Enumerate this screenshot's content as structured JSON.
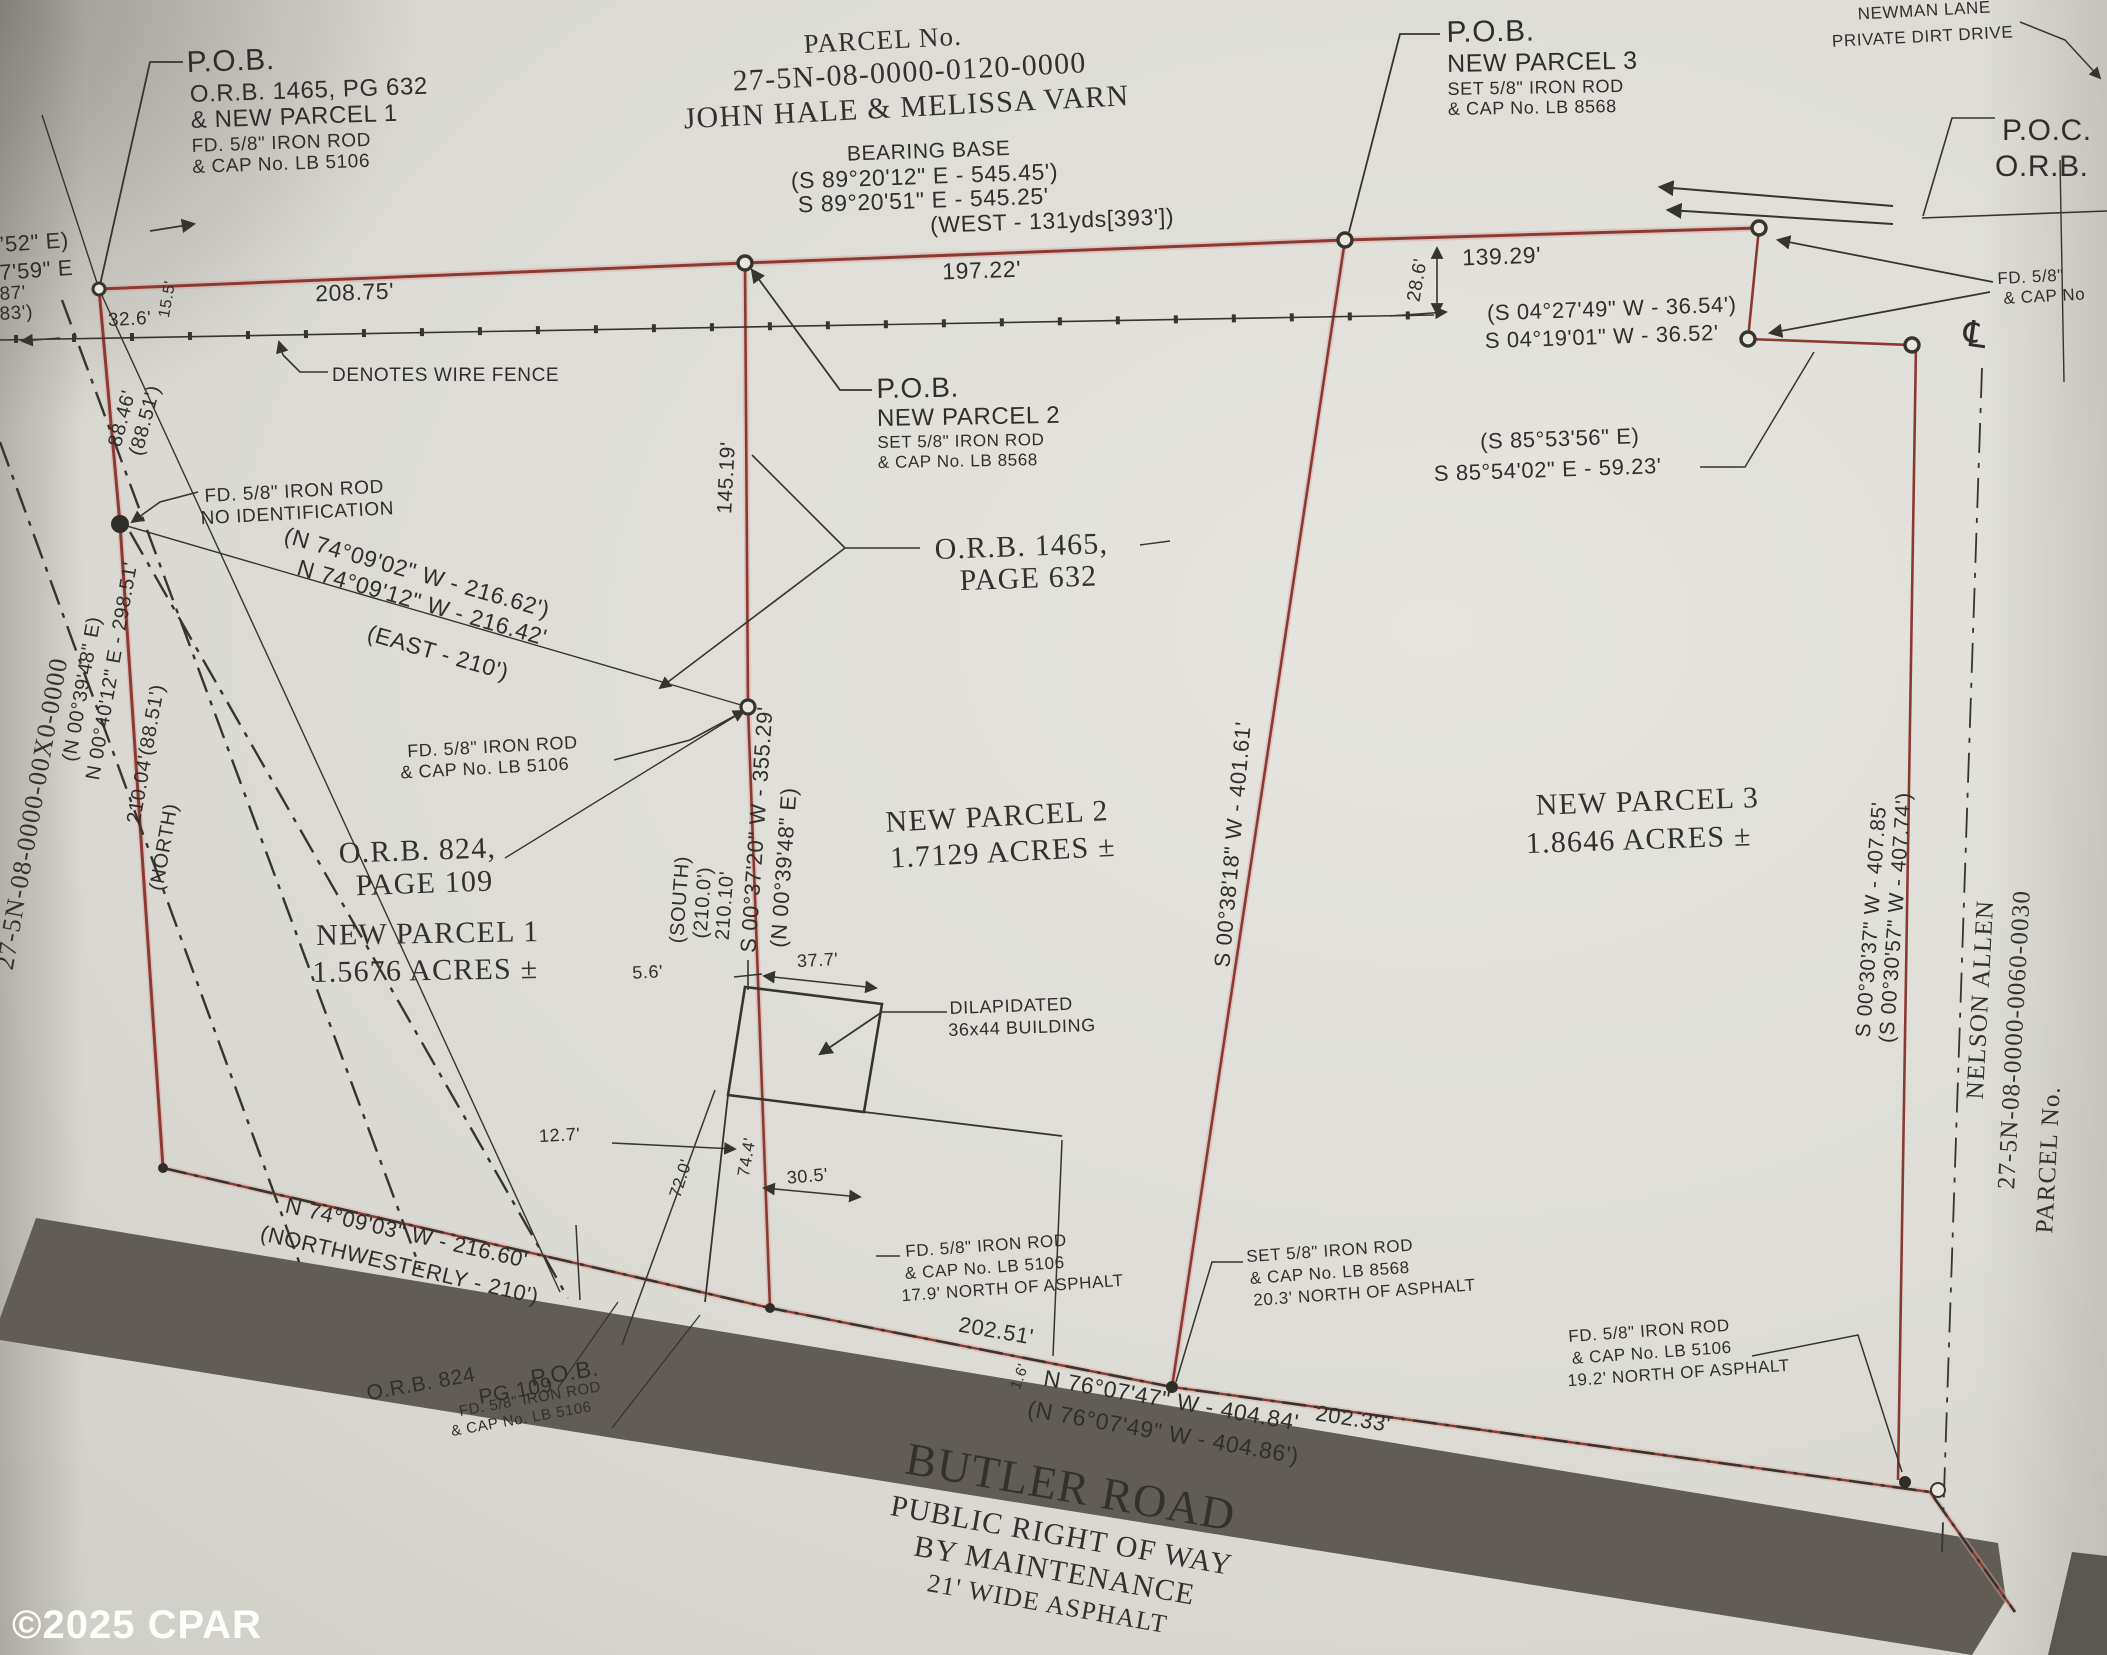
{
  "plat": {
    "watermark": "©2025 CPAR",
    "subject_parcel": {
      "label": "PARCEL No.",
      "number": "27-5N-08-0000-0120-0000",
      "owner": "JOHN HALE & MELISSA VARN"
    },
    "bearing_base": {
      "title": "BEARING BASE",
      "record": "(S 89°20'12\" E - 545.45')",
      "measured": "S 89°20'51\" E - 545.25'",
      "west_tie": "(WEST - 131yds[393'])"
    },
    "pob_parcel1": [
      "P.O.B.",
      "O.R.B. 1465, PG 632",
      "& NEW PARCEL 1",
      "FD. 5/8\" IRON ROD",
      "& CAP No. LB 5106"
    ],
    "pob_parcel2": [
      "P.O.B.",
      "NEW PARCEL 2",
      "SET 5/8\" IRON ROD",
      "& CAP No. LB 8568"
    ],
    "pob_parcel3": [
      "P.O.B.",
      "NEW PARCEL 3",
      "SET 5/8\" IRON ROD",
      "& CAP No. LB 8568"
    ],
    "poc": [
      "P.O.C.",
      "O.R.B."
    ],
    "newman_lane": [
      "NEWMAN LANE",
      "PRIVATE DIRT DRIVE"
    ],
    "fence_legend": "DENOTES WIRE FENCE",
    "centerline_symbol": "℄",
    "parcels": [
      {
        "name": "NEW PARCEL 1",
        "area": "1.5676 ACRES ±"
      },
      {
        "name": "NEW PARCEL 2",
        "area": "1.7129 ACRES ±"
      },
      {
        "name": "NEW PARCEL 3",
        "area": "1.8646 ACRES ±"
      }
    ],
    "deed_refs": {
      "orb_1465": [
        "O.R.B. 1465,",
        "PAGE 632"
      ],
      "orb_824": [
        "O.R.B. 824,",
        "PAGE 109"
      ],
      "orb_824_road": [
        "O.R.B. 824",
        "PG 109"
      ]
    },
    "monuments": {
      "no_id": [
        "FD. 5/8\" IRON ROD",
        "NO IDENTIFICATION"
      ],
      "mid": [
        "FD. 5/8\" IRON ROD",
        "& CAP No. LB 5106"
      ],
      "road_pob": [
        "P.O.B.",
        "FD. 5/8\" IRON ROD",
        "& CAP No. LB 5106"
      ],
      "road_17_9": [
        "FD. 5/8\" IRON ROD",
        "& CAP No. LB 5106",
        "17.9' NORTH OF ASPHALT"
      ],
      "road_20_3": [
        "SET 5/8\" IRON ROD",
        "& CAP No. LB 8568",
        "20.3' NORTH OF ASPHALT"
      ],
      "road_19_2": [
        "FD. 5/8\" IRON ROD",
        "& CAP No. LB 5106",
        "19.2' NORTH OF ASPHALT"
      ],
      "right_edge": [
        "FD. 5/8\"",
        "& CAP No"
      ]
    },
    "bearings": {
      "north_216": [
        "(N 74°09'02\" W - 216.62')",
        "N 74°09'12\" W - 216.42'",
        "(EAST - 210')"
      ],
      "east_36": [
        "(S 04°27'49\" W - 36.54')",
        "S 04°19'01\" W - 36.52'"
      ],
      "east_59": [
        "(S 85°53'56\" E)",
        "S 85°54'02\" E - 59.23'"
      ],
      "west_line": [
        "(N 00°39'48\" E)",
        "N 00°40'12\" E - 298.51'",
        "210.04'(88.51')",
        "(NORTH)",
        "88.46'",
        "(88.51')"
      ],
      "line1": [
        "S 00°37'20\" W - 355.29'",
        "(N 00°39'48\" E)",
        "(SOUTH)",
        "(210.0')",
        "210.10'"
      ],
      "line2": "S 00°38'18\" W - 401.61'",
      "east_boundary": [
        "S 00°30'37\" W - 407.85'",
        "(S 00°30'57\" W - 407.74')"
      ],
      "road_left": [
        "N 74°09'03\" W - 216.60'",
        "(NORTHWESTERLY - 210')"
      ],
      "road_main": [
        "N 76°07'47\" W - 404.84'",
        "(N 76°07'49\" W - 404.86')"
      ]
    },
    "distances": {
      "d208": "208.75'",
      "d197": "197.22'",
      "d139": "139.29'",
      "d32": "32.6'",
      "d15": "15.5'",
      "d28": "28.6'",
      "d145": "145.19'",
      "d202a": "202.51'",
      "d202b": "202.33'",
      "d1_6": "1.6'",
      "b5_6": "5.6'",
      "b37": "37.7'",
      "b12": "12.7'",
      "b30": "30.5'",
      "b72": "72.0'",
      "b74": "74.4'"
    },
    "building": [
      "DILAPIDATED",
      "36x44 BUILDING"
    ],
    "adjoiners": {
      "west": "27-5N-08-0000-00X0-0000",
      "east": [
        "PARCEL No.",
        "27-5N-08-0000-0060-0030",
        "NELSON ALLEN"
      ]
    },
    "road_name": [
      "BUTLER ROAD",
      "PUBLIC RIGHT OF WAY",
      "BY MAINTENANCE",
      "21' WIDE ASPHALT"
    ],
    "edge_fragments": [
      "’52\" E)",
      "7'59\" E",
      "87'",
      "83')"
    ]
  }
}
